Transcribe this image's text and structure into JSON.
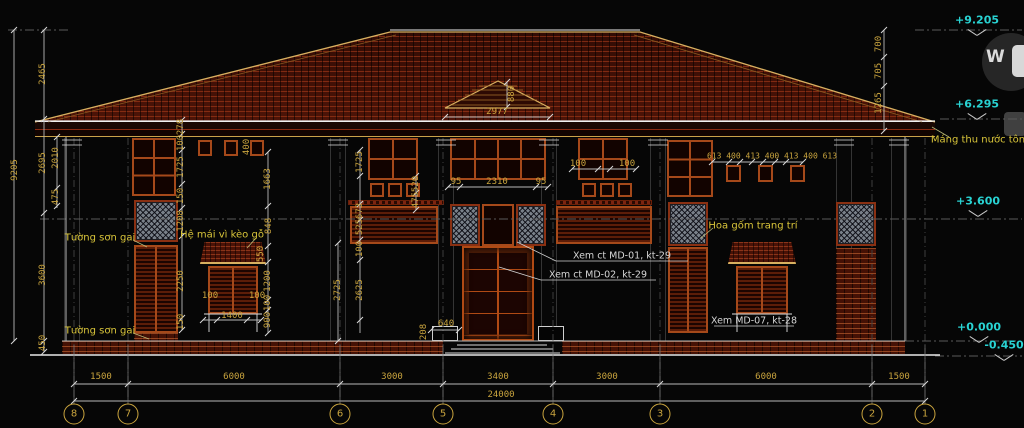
{
  "drawing": {
    "watermark": {
      "letter": "W"
    },
    "colors": {
      "background": "#060606",
      "roof_tile": "#451006",
      "roof_hatch": "#8a2a12",
      "dim_text": "#c9a43e",
      "note_text": "#d9c53a",
      "level_text": "#29d3d3",
      "frame": "#a5491a",
      "lattice": "#798089",
      "line": "#c9c9c9"
    }
  },
  "levels": [
    {
      "t": "+9.205",
      "x": 977,
      "y": 20,
      "my": 29
    },
    {
      "t": "+6.295",
      "x": 977,
      "y": 104,
      "my": 113
    },
    {
      "t": "+3.600",
      "x": 978,
      "y": 201,
      "my": 210
    },
    {
      "t": "+0.000",
      "x": 979,
      "y": 327,
      "my": 336
    },
    {
      "t": "-0.450",
      "x": 1004,
      "y": 345,
      "my": 354
    }
  ],
  "grid_bubbles": [
    {
      "n": "8",
      "x": 74
    },
    {
      "n": "7",
      "x": 128
    },
    {
      "n": "6",
      "x": 340
    },
    {
      "n": "5",
      "x": 443
    },
    {
      "n": "4",
      "x": 553
    },
    {
      "n": "3",
      "x": 660
    },
    {
      "n": "2",
      "x": 872
    },
    {
      "n": "1",
      "x": 925
    }
  ],
  "annotations": [
    {
      "t": "2977",
      "x": 497,
      "y": 112,
      "c": "d"
    },
    {
      "t": "880",
      "x": 512,
      "y": 94,
      "c": "d",
      "r": 1
    },
    {
      "t": "95",
      "x": 456,
      "y": 182,
      "c": "d"
    },
    {
      "t": "2310",
      "x": 497,
      "y": 182,
      "c": "d"
    },
    {
      "t": "95",
      "x": 541,
      "y": 182,
      "c": "d"
    },
    {
      "t": "100",
      "x": 578,
      "y": 164,
      "c": "d"
    },
    {
      "t": "100",
      "x": 627,
      "y": 164,
      "c": "d"
    },
    {
      "t": "613 400 413 400 413 400 613",
      "x": 772,
      "y": 156,
      "c": "d",
      "s": 8
    },
    {
      "t": "100",
      "x": 210,
      "y": 296,
      "c": "d"
    },
    {
      "t": "100",
      "x": 257,
      "y": 296,
      "c": "d"
    },
    {
      "t": "1400",
      "x": 232,
      "y": 316,
      "c": "d"
    },
    {
      "t": "640",
      "x": 446,
      "y": 324,
      "c": "d"
    },
    {
      "t": "1500",
      "x": 101,
      "y": 377,
      "c": "d"
    },
    {
      "t": "6000",
      "x": 234,
      "y": 377,
      "c": "d"
    },
    {
      "t": "3000",
      "x": 392,
      "y": 377,
      "c": "d"
    },
    {
      "t": "3400",
      "x": 498,
      "y": 377,
      "c": "d"
    },
    {
      "t": "3000",
      "x": 607,
      "y": 377,
      "c": "d"
    },
    {
      "t": "6000",
      "x": 766,
      "y": 377,
      "c": "d"
    },
    {
      "t": "1500",
      "x": 899,
      "y": 377,
      "c": "d"
    },
    {
      "t": "24000",
      "x": 501,
      "y": 395,
      "c": "d"
    },
    {
      "t": "9205",
      "x": 15,
      "y": 170,
      "c": "d",
      "r": 1
    },
    {
      "t": "2465",
      "x": 43,
      "y": 74,
      "c": "d",
      "r": 1
    },
    {
      "t": "2695",
      "x": 43,
      "y": 163,
      "c": "d",
      "r": 1
    },
    {
      "t": "2010",
      "x": 56,
      "y": 158,
      "c": "d",
      "r": 1
    },
    {
      "t": "475",
      "x": 56,
      "y": 197,
      "c": "d",
      "r": 1
    },
    {
      "t": "3600",
      "x": 43,
      "y": 275,
      "c": "d",
      "r": 1
    },
    {
      "t": "450",
      "x": 43,
      "y": 343,
      "c": "d",
      "r": 1
    },
    {
      "t": "278",
      "x": 181,
      "y": 127,
      "c": "d",
      "r": 1
    },
    {
      "t": "100",
      "x": 181,
      "y": 143,
      "c": "d",
      "r": 1
    },
    {
      "t": "1725",
      "x": 181,
      "y": 167,
      "c": "d",
      "r": 1
    },
    {
      "t": "150",
      "x": 181,
      "y": 196,
      "c": "d",
      "r": 1
    },
    {
      "t": "1208",
      "x": 181,
      "y": 221,
      "c": "d",
      "r": 1
    },
    {
      "t": "2250",
      "x": 181,
      "y": 281,
      "c": "d",
      "r": 1
    },
    {
      "t": "150",
      "x": 181,
      "y": 322,
      "c": "d",
      "r": 1
    },
    {
      "t": "400",
      "x": 247,
      "y": 147,
      "c": "d",
      "r": 1
    },
    {
      "t": "1663",
      "x": 268,
      "y": 179,
      "c": "d",
      "r": 1
    },
    {
      "t": "848",
      "x": 269,
      "y": 226,
      "c": "d",
      "r": 1
    },
    {
      "t": "550",
      "x": 261,
      "y": 254,
      "c": "d",
      "r": 1
    },
    {
      "t": "1200",
      "x": 268,
      "y": 281,
      "c": "d",
      "r": 1
    },
    {
      "t": "100",
      "x": 268,
      "y": 303,
      "c": "d",
      "r": 1
    },
    {
      "t": "900",
      "x": 268,
      "y": 320,
      "c": "d",
      "r": 1
    },
    {
      "t": "1725",
      "x": 360,
      "y": 162,
      "c": "d",
      "r": 1
    },
    {
      "t": "673",
      "x": 360,
      "y": 211,
      "c": "d",
      "r": 1
    },
    {
      "t": "525",
      "x": 360,
      "y": 227,
      "c": "d",
      "r": 1
    },
    {
      "t": "100",
      "x": 360,
      "y": 249,
      "c": "d",
      "r": 1
    },
    {
      "t": "2625",
      "x": 360,
      "y": 290,
      "c": "d",
      "r": 1
    },
    {
      "t": "2725",
      "x": 338,
      "y": 290,
      "c": "d",
      "r": 1
    },
    {
      "t": "520",
      "x": 416,
      "y": 184,
      "c": "d",
      "r": 1
    },
    {
      "t": "475",
      "x": 416,
      "y": 200,
      "c": "d",
      "r": 1
    },
    {
      "t": "208",
      "x": 424,
      "y": 332,
      "c": "d",
      "r": 1
    },
    {
      "t": "700",
      "x": 879,
      "y": 44,
      "c": "d",
      "r": 1
    },
    {
      "t": "705",
      "x": 879,
      "y": 71,
      "c": "d",
      "r": 1
    },
    {
      "t": "1265",
      "x": 879,
      "y": 103,
      "c": "d",
      "r": 1
    },
    {
      "t": "Tường sơn gai",
      "x": 100,
      "y": 238,
      "c": "n",
      "nm": "note-tuong-son-gai-upper"
    },
    {
      "t": "Tường sơn gai",
      "x": 100,
      "y": 331,
      "c": "n",
      "nm": "note-tuong-son-gai-lower"
    },
    {
      "t": "Hệ mái vì kèo gỗ",
      "x": 222,
      "y": 235,
      "c": "n",
      "nm": "note-he-mai-vi-keo-go"
    },
    {
      "t": "Hoa gốm trang trí",
      "x": 753,
      "y": 226,
      "c": "n",
      "nm": "note-hoa-gom-trang-tri"
    },
    {
      "t": "Máng thu nước tôn",
      "x": 978,
      "y": 140,
      "c": "n",
      "nm": "note-mang-thu-nuoc-ton"
    },
    {
      "t": "Xem ct MD-01, kt-29",
      "x": 622,
      "y": 256,
      "c": "w",
      "nm": "note-xem-ct-md-01"
    },
    {
      "t": "Xem ct MD-02, kt-29",
      "x": 598,
      "y": 275,
      "c": "w",
      "nm": "note-xem-ct-md-02"
    },
    {
      "t": "Xem MD-07, kt-28",
      "x": 754,
      "y": 321,
      "c": "w",
      "nm": "note-xem-md-07"
    }
  ]
}
